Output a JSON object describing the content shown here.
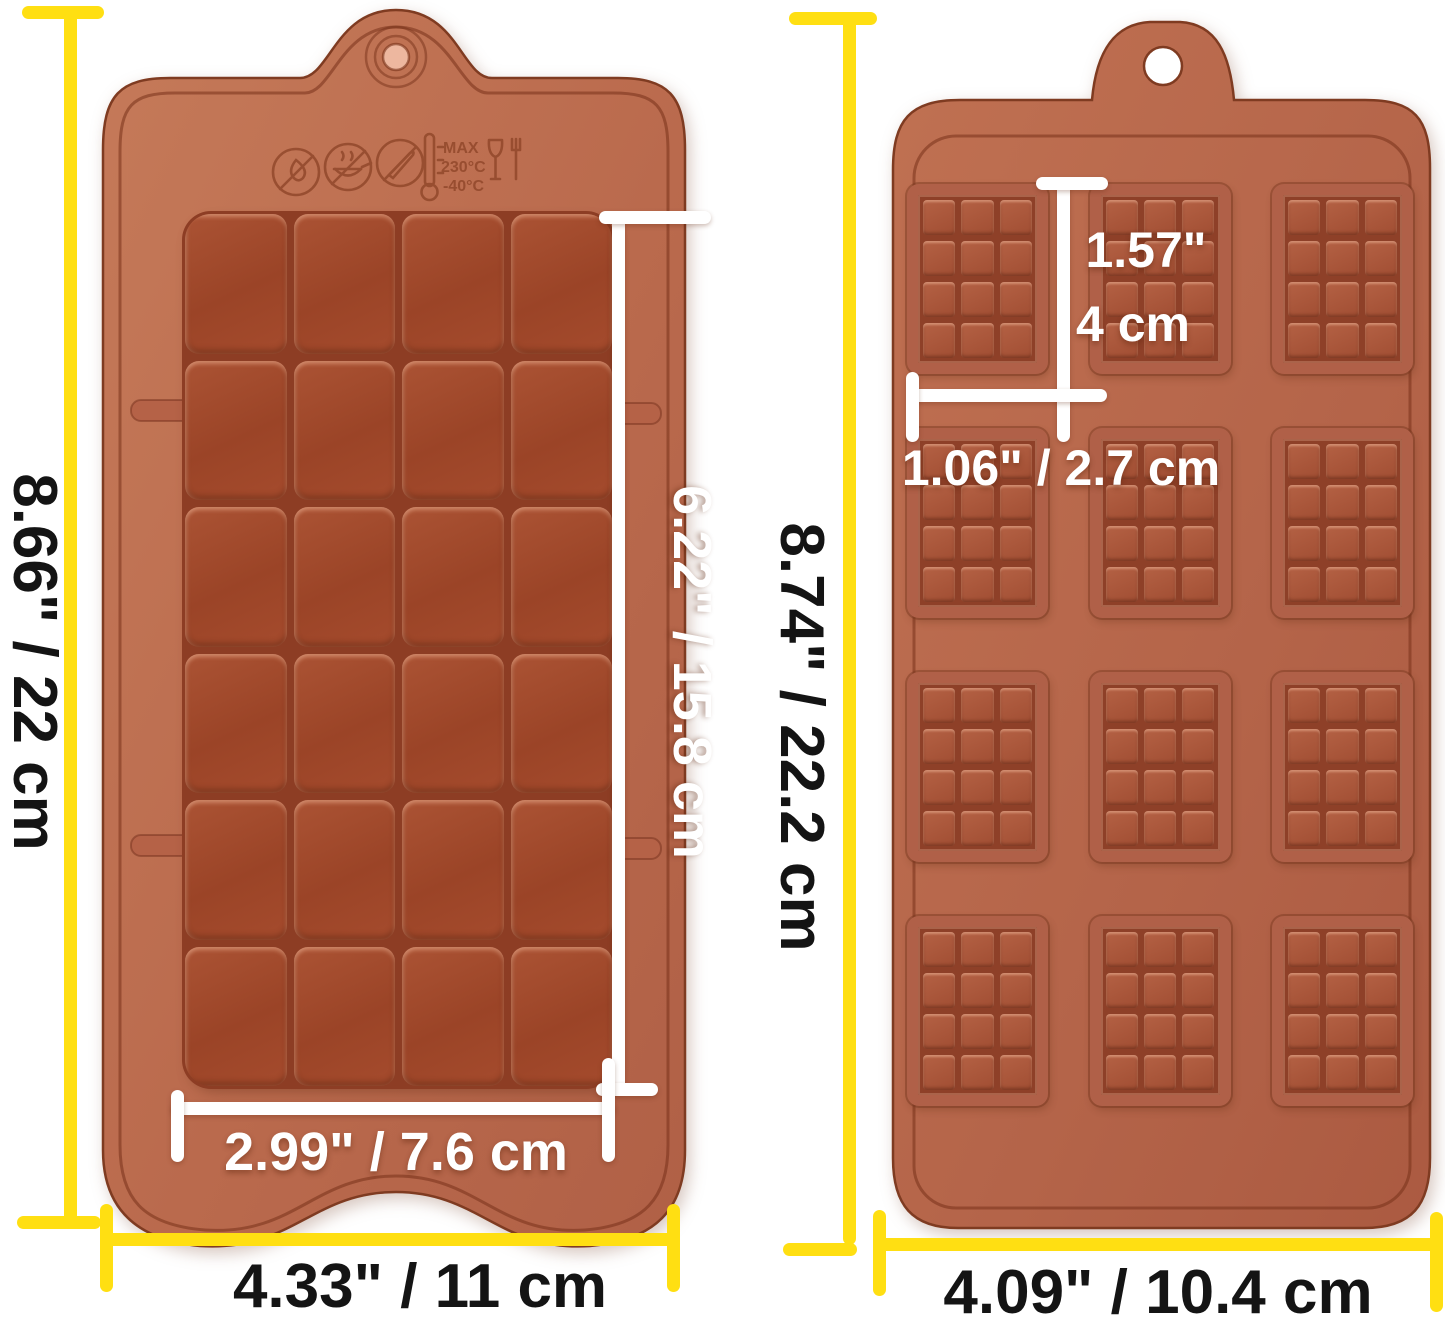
{
  "image_type": "silicone chocolate mold dimension photo",
  "left_mold": {
    "name": "break-apart chocolate bar mold",
    "rows": 6,
    "cols": 4,
    "height_label": "8.66\" / 22 cm",
    "width_label": "4.33\" / 11 cm",
    "bar_height_label": "6.22\" / 15.8 cm",
    "bar_width_label": "2.99\" / 7.6 cm",
    "embossed": {
      "max": "MAX",
      "temp_high": "230°C",
      "temp_low": "-40°C"
    }
  },
  "right_mold": {
    "name": "mini chocolate bar mold",
    "bar_rows": 4,
    "bar_cols": 3,
    "chunk_rows": 4,
    "chunk_cols": 3,
    "height_label": "8.74\" / 22.2 cm",
    "width_label": "4.09\" / 10.4 cm",
    "bar_height_label_in": "1.57\"",
    "bar_height_label_cm": "4 cm",
    "bar_width_label": "1.06\" / 2.7 cm"
  },
  "colors": {
    "background": "#ffffff",
    "dimension_yellow": "#ffdf12",
    "dimension_white": "#ffffff",
    "dimension_text_dark": "#141414",
    "mold_base_light": "#c37757",
    "mold_base": "#b4644a",
    "bar_cell": "#a04a2d",
    "groove": "#8d3d24",
    "edge": "#7f3b21"
  }
}
